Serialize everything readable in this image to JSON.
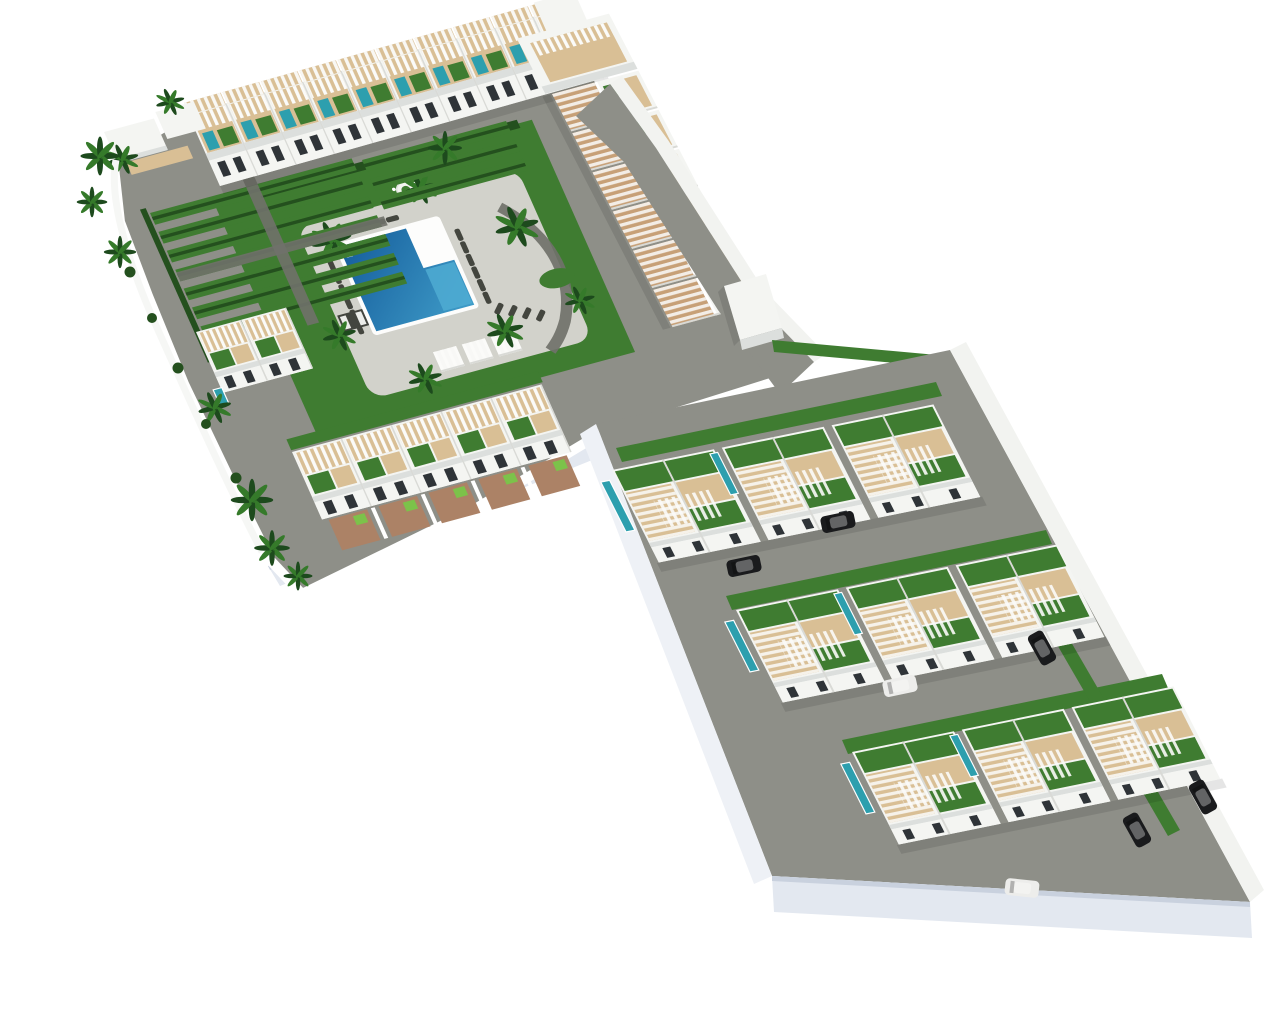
{
  "scene": {
    "type": "3d-aerial-architectural-render",
    "subject": "residential resort development with central pool courtyard and townhouse rows",
    "background_label": "white studio background",
    "view": "high-angle axonometric from south-west"
  },
  "colors": {
    "background": "#ffffff",
    "building_white": "#f4f5f2",
    "building_shade": "#dcdfdd",
    "wall_light": "#eef1f6",
    "window_dark": "#2f3438",
    "road_gray": "#8e8f88",
    "path_gray": "#70716a",
    "deck_light": "#d2d2cb",
    "deck_tan": "#c7a077",
    "deck_tan_light": "#d9bf95",
    "grass": "#3f7c31",
    "grass_dark": "#24501e",
    "pool_blue": "#1b66a6",
    "pool_blue_light": "#4facd2",
    "pool_teal": "#2d9fae",
    "brick": "#ac8266",
    "brick_lime": "#7cc24a",
    "palm_green": "#1d4a1d",
    "palm_light": "#357a2a",
    "lounger_gray": "#44463f",
    "slab_face": "#e3e8f0",
    "slab_edge": "#c9d1de",
    "sidewalk": "#f2f3f0",
    "car_dark": "#1a1b1d",
    "car_white": "#ededeb",
    "pergola_white": "#fbfbf9"
  },
  "inventory": {
    "north_row_units": 10,
    "east_terrace_steps": 6,
    "south_row_units": 5,
    "garden_strip_count": 10,
    "pool_shape": "L-shaped",
    "cabanas": 3,
    "sun_loungers": 21,
    "townhouse_rows": 3,
    "duplexes_per_row": 3,
    "rooftop_plunge_pools_per_row": 2,
    "parked_cars_dark": 5,
    "parked_cars_white": 2,
    "palm_trees": 15
  }
}
